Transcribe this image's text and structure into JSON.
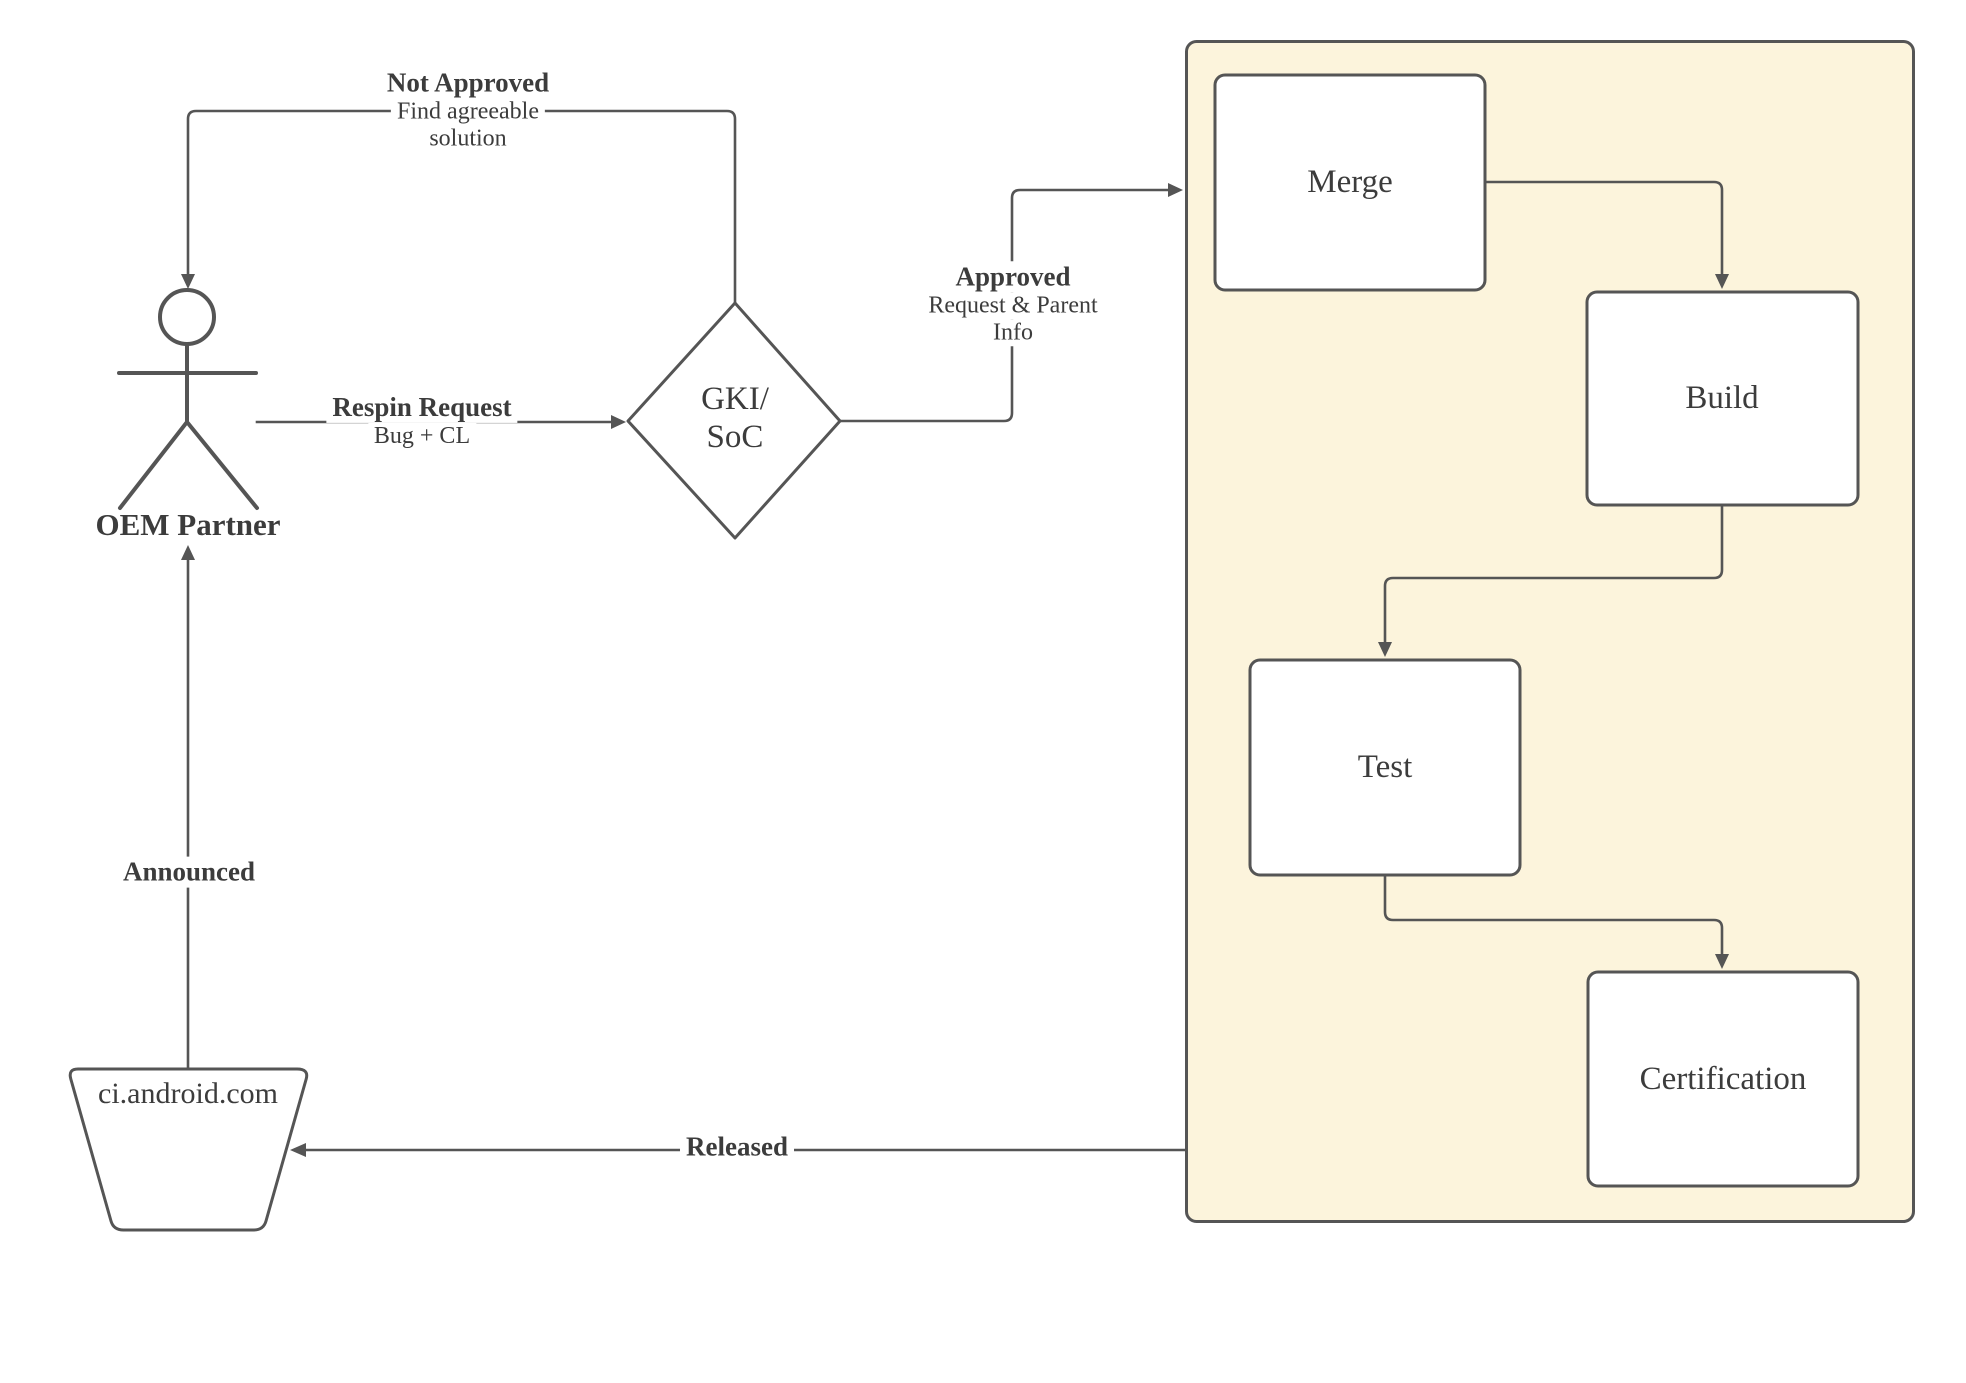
{
  "colors": {
    "page_bg": "#ffffff",
    "stroke": "#555555",
    "text": "#3c3c3c",
    "container_fill": "#fcf4dc",
    "node_fill": "#ffffff"
  },
  "actor": {
    "label": "OEM Partner"
  },
  "datastore": {
    "label": "ci.android.com"
  },
  "decision": {
    "label_line1": "GKI/",
    "label_line2": "SoC"
  },
  "container": {
    "steps": [
      {
        "label": "Merge"
      },
      {
        "label": "Build"
      },
      {
        "label": "Test"
      },
      {
        "label": "Certification"
      }
    ]
  },
  "edges": {
    "not_approved": {
      "title": "Not Approved",
      "sub1": "Find agreeable",
      "sub2": "solution"
    },
    "respin": {
      "title": "Respin Request",
      "sub": "Bug + CL"
    },
    "approved": {
      "title": "Approved",
      "sub1": "Request & Parent",
      "sub2": "Info"
    },
    "announced": {
      "title": "Announced"
    },
    "released": {
      "title": "Released"
    }
  }
}
